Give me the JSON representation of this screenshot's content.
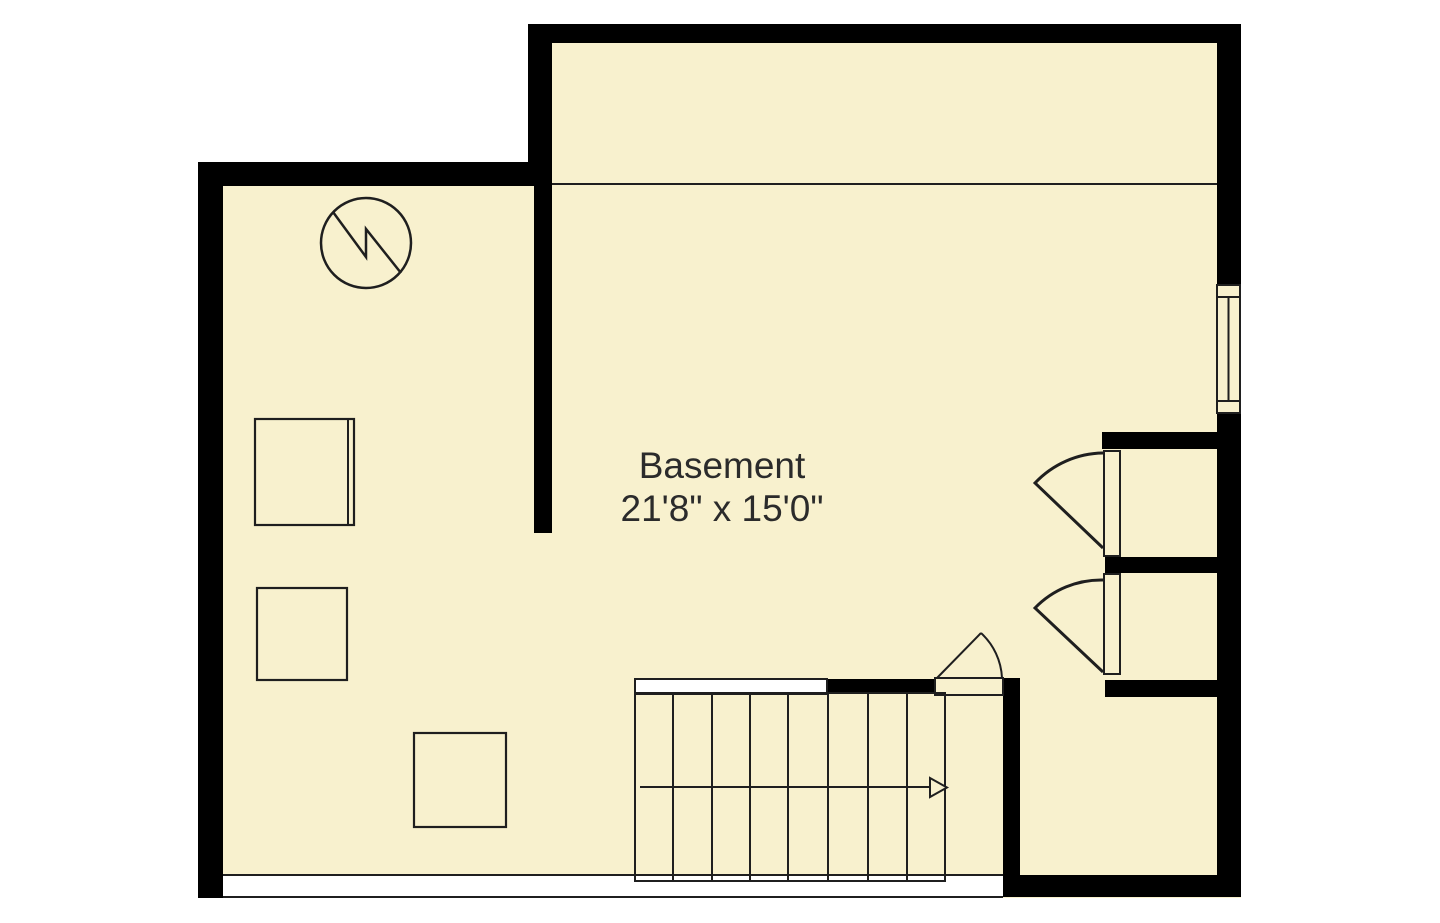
{
  "floor_plan": {
    "room": {
      "label": "Basement",
      "dimensions": "21'8\" x 15'0\""
    },
    "colors": {
      "floor": "#F8F1CE",
      "wall": "#000000",
      "line": "#1F1F1F",
      "text": "#2B2B2B",
      "background": "#FFFFFF"
    },
    "symbols": {
      "utility": "circle-zigzag-symbol",
      "stairs": "staircase-with-direction-arrow",
      "window": "double-pane-window",
      "doors": [
        "closet-door-upper",
        "closet-door-lower",
        "stair-landing-door"
      ],
      "fixtures": [
        "storage-box-1",
        "storage-box-2",
        "storage-box-3"
      ]
    }
  }
}
